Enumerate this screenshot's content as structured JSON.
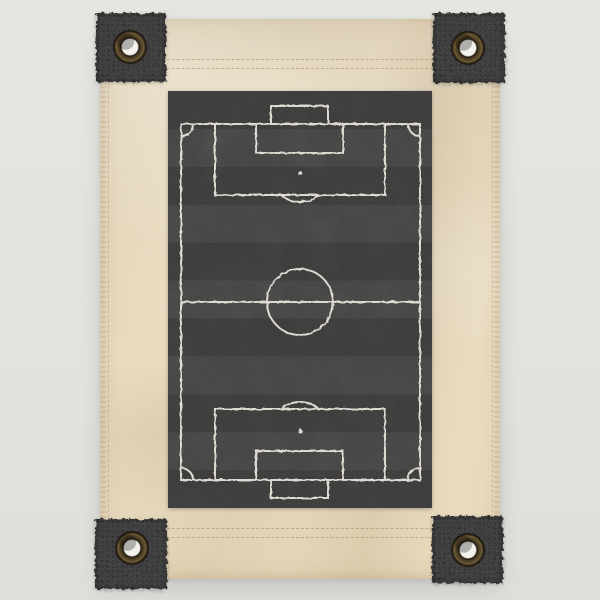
{
  "meta": {
    "alt": "Tan canvas wall banner with a dark charcoal felt soccer field print, frayed black corner patches and bronze grommets at all four corners"
  },
  "palette": {
    "background": "#e2e2de",
    "canvas": "#ebdfc6",
    "patch": "#3b3b3b",
    "field_dark": "#3a3939",
    "field_light": "#464545",
    "chalk_line": "#e9e4dc",
    "grommet_bronze": "#59482a",
    "grommet_hole": "#f3f2ed",
    "stitch": "#a08a5f"
  },
  "banner": {
    "x": 100,
    "y": 19,
    "w": 400,
    "h": 560
  },
  "print": {
    "x": 168,
    "y": 91,
    "w": 264,
    "h": 417
  },
  "stripes": {
    "count": 11,
    "first": "dark"
  },
  "pitch": {
    "line_width": 2,
    "boundary": {
      "x": 13,
      "y": 33,
      "w": 239,
      "h": 356
    },
    "halfway_y": 211,
    "center_circle": {
      "cx": 132,
      "cy": 211,
      "r": 33
    },
    "penalty_areas": [
      {
        "x": 47,
        "y": 33,
        "w": 170,
        "h": 71
      },
      {
        "x": 47,
        "y": 318,
        "w": 170,
        "h": 71
      }
    ],
    "goal_areas": [
      {
        "x": 88,
        "y": 33,
        "w": 87,
        "h": 29
      },
      {
        "x": 88,
        "y": 360,
        "w": 87,
        "h": 29
      }
    ],
    "goal_boxes": [
      {
        "x": 103,
        "y": 15,
        "w": 57,
        "h": 18
      },
      {
        "x": 103,
        "y": 389,
        "w": 57,
        "h": 18
      }
    ],
    "penalty_spots": [
      {
        "cx": 132,
        "cy": 82,
        "r": 2.2
      },
      {
        "cx": 132,
        "cy": 340,
        "r": 2.2
      }
    ],
    "penalty_arcs": [
      {
        "cx": 132,
        "cy": 82,
        "r": 29
      },
      {
        "cx": 132,
        "cy": 340,
        "r": 29
      }
    ],
    "arc_clips": [
      {
        "x": 100,
        "y": 104,
        "w": 64,
        "h": 30
      },
      {
        "x": 100,
        "y": 288,
        "w": 64,
        "h": 30
      }
    ],
    "corner_radius": 12
  },
  "patches": [
    {
      "name": "top-left",
      "x": 96,
      "y": 13,
      "w": 70,
      "h": 69,
      "grommet": {
        "cx": 130,
        "cy": 47
      }
    },
    {
      "name": "top-right",
      "x": 433,
      "y": 13,
      "w": 72,
      "h": 70,
      "grommet": {
        "cx": 468,
        "cy": 48
      }
    },
    {
      "name": "bottom-left",
      "x": 95,
      "y": 519,
      "w": 72,
      "h": 70,
      "grommet": {
        "cx": 132,
        "cy": 548
      }
    },
    {
      "name": "bottom-right",
      "x": 432,
      "y": 516,
      "w": 71,
      "h": 67,
      "grommet": {
        "cx": 468,
        "cy": 550
      }
    }
  ],
  "grommet_size": 36,
  "stitches": {
    "horizontal": [
      {
        "name": "top-seam-1",
        "x1": 107,
        "x2": 493,
        "y": 59
      },
      {
        "name": "top-seam-2",
        "x1": 107,
        "x2": 493,
        "y": 68
      },
      {
        "name": "bottom-seam-1",
        "x1": 107,
        "x2": 493,
        "y": 528
      },
      {
        "name": "bottom-seam-2",
        "x1": 107,
        "x2": 493,
        "y": 537
      }
    ],
    "vertical": [
      {
        "name": "left-seam",
        "x": 108,
        "y1": 26,
        "y2": 572
      },
      {
        "name": "right-seam",
        "x": 492,
        "y1": 26,
        "y2": 572
      }
    ]
  }
}
